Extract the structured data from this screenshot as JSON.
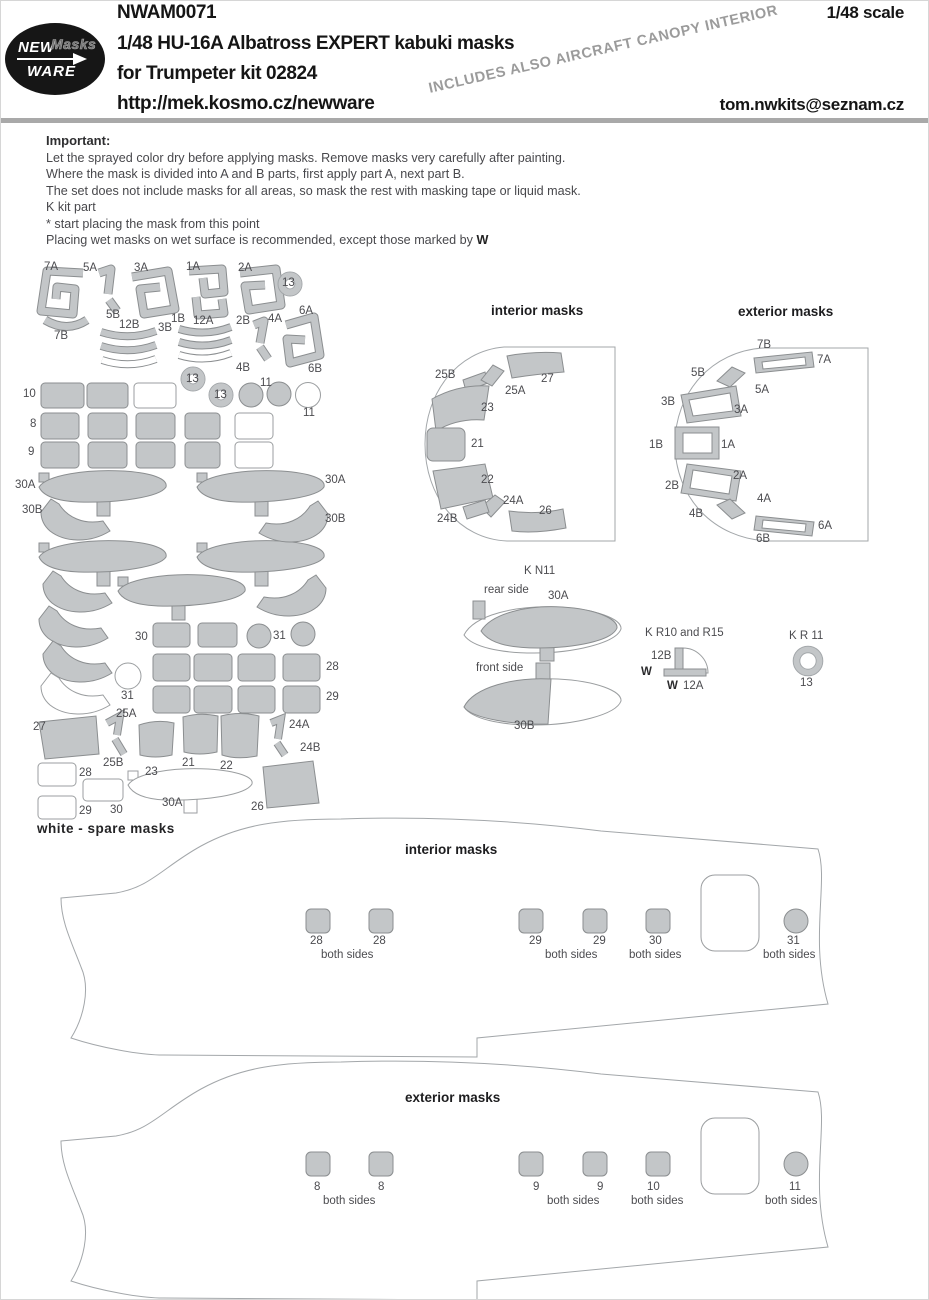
{
  "colors": {
    "mask_fill": "#c3c6c8",
    "mask_stroke": "#8b8e90",
    "outline": "#a3a7aa",
    "divider": "#a9a9a9",
    "banner_text": "#9b9b9b"
  },
  "header": {
    "logo": {
      "line1": "NEW",
      "line2": "Masks",
      "line3": "WARE"
    },
    "code": "NWAM0071",
    "title_line1": "1/48  HU-16A Albatross EXPERT kabuki masks",
    "title_line2": "for Trumpeter kit 02824",
    "url": "http://mek.kosmo.cz/newware",
    "scale": "1/48 scale",
    "banner": "INCLUDES ALSO AIRCRAFT CANOPY INTERIOR",
    "email": "tom.nwkits@seznam.cz"
  },
  "instructions": {
    "heading": "Important:",
    "lines": [
      "Let the sprayed color dry before applying masks. Remove masks very carefully after painting.",
      "Where the mask is divided into A and B parts, first apply part A, next part B.",
      "The set does not include masks for all areas, so mask the rest with masking tape or liquid mask.",
      "K  kit part",
      "*   start placing the mask from this point"
    ],
    "wet_line_prefix": "Placing wet masks on wet surface is recommended, except those marked by ",
    "wet_marker": "W"
  },
  "sheet": {
    "spare_note": "white - spare masks",
    "labels": [
      {
        "t": "7A",
        "x": 35,
        "y": 5
      },
      {
        "t": "5A",
        "x": 74,
        "y": 6
      },
      {
        "t": "3A",
        "x": 125,
        "y": 6
      },
      {
        "t": "1A",
        "x": 177,
        "y": 5
      },
      {
        "t": "2A",
        "x": 229,
        "y": 6
      },
      {
        "t": "13",
        "x": 273,
        "y": 21
      },
      {
        "t": "7B",
        "x": 45,
        "y": 74
      },
      {
        "t": "5B",
        "x": 97,
        "y": 53
      },
      {
        "t": "12B",
        "x": 110,
        "y": 63
      },
      {
        "t": "3B",
        "x": 149,
        "y": 66
      },
      {
        "t": "1B",
        "x": 162,
        "y": 57
      },
      {
        "t": "12A",
        "x": 184,
        "y": 59
      },
      {
        "t": "2B",
        "x": 227,
        "y": 59
      },
      {
        "t": "4A",
        "x": 259,
        "y": 57
      },
      {
        "t": "6A",
        "x": 290,
        "y": 49
      },
      {
        "t": "4B",
        "x": 227,
        "y": 106
      },
      {
        "t": "6B",
        "x": 299,
        "y": 107
      },
      {
        "t": "13",
        "x": 177,
        "y": 117
      },
      {
        "t": "13",
        "x": 205,
        "y": 133
      },
      {
        "t": "11",
        "x": 251,
        "y": 121
      },
      {
        "t": "11",
        "x": 294,
        "y": 151
      },
      {
        "t": "10",
        "x": 14,
        "y": 132
      },
      {
        "t": "8",
        "x": 21,
        "y": 162
      },
      {
        "t": "9",
        "x": 19,
        "y": 190
      },
      {
        "t": "30A",
        "x": 6,
        "y": 223
      },
      {
        "t": "30A",
        "x": 316,
        "y": 218
      },
      {
        "t": "30B",
        "x": 13,
        "y": 248
      },
      {
        "t": "30B",
        "x": 316,
        "y": 257
      },
      {
        "t": "30",
        "x": 126,
        "y": 375
      },
      {
        "t": "31",
        "x": 264,
        "y": 374
      },
      {
        "t": "28",
        "x": 317,
        "y": 405
      },
      {
        "t": "29",
        "x": 317,
        "y": 435
      },
      {
        "t": "31",
        "x": 112,
        "y": 434
      },
      {
        "t": "25A",
        "x": 107,
        "y": 452
      },
      {
        "t": "27",
        "x": 24,
        "y": 465
      },
      {
        "t": "25B",
        "x": 94,
        "y": 501
      },
      {
        "t": "23",
        "x": 136,
        "y": 510
      },
      {
        "t": "21",
        "x": 173,
        "y": 501
      },
      {
        "t": "22",
        "x": 211,
        "y": 504
      },
      {
        "t": "24A",
        "x": 280,
        "y": 463
      },
      {
        "t": "24B",
        "x": 291,
        "y": 486
      },
      {
        "t": "28",
        "x": 70,
        "y": 511
      },
      {
        "t": "30",
        "x": 101,
        "y": 548
      },
      {
        "t": "29",
        "x": 70,
        "y": 549
      },
      {
        "t": "30A",
        "x": 153,
        "y": 541
      },
      {
        "t": "26",
        "x": 242,
        "y": 545
      }
    ]
  },
  "interior_diagram": {
    "title": "interior masks",
    "labels": [
      {
        "t": "25B",
        "x": 16,
        "y": 68
      },
      {
        "t": "25A",
        "x": 86,
        "y": 84
      },
      {
        "t": "27",
        "x": 122,
        "y": 72
      },
      {
        "t": "23",
        "x": 62,
        "y": 101
      },
      {
        "t": "21",
        "x": 52,
        "y": 137
      },
      {
        "t": "22",
        "x": 62,
        "y": 173
      },
      {
        "t": "24A",
        "x": 84,
        "y": 194
      },
      {
        "t": "24B",
        "x": 18,
        "y": 212
      },
      {
        "t": "26",
        "x": 120,
        "y": 204
      }
    ]
  },
  "exterior_diagram": {
    "title": "exterior masks",
    "labels": [
      {
        "t": "7B",
        "x": 108,
        "y": 38
      },
      {
        "t": "7A",
        "x": 168,
        "y": 53
      },
      {
        "t": "5B",
        "x": 42,
        "y": 66
      },
      {
        "t": "5A",
        "x": 106,
        "y": 83
      },
      {
        "t": "3B",
        "x": 12,
        "y": 95
      },
      {
        "t": "3A",
        "x": 85,
        "y": 103
      },
      {
        "t": "1B",
        "x": 0,
        "y": 138
      },
      {
        "t": "1A",
        "x": 72,
        "y": 138
      },
      {
        "t": "2B",
        "x": 16,
        "y": 179
      },
      {
        "t": "2A",
        "x": 84,
        "y": 169
      },
      {
        "t": "4B",
        "x": 40,
        "y": 207
      },
      {
        "t": "4A",
        "x": 108,
        "y": 192
      },
      {
        "t": "6B",
        "x": 107,
        "y": 232
      },
      {
        "t": "6A",
        "x": 169,
        "y": 219
      }
    ]
  },
  "kn11": {
    "labels": [
      {
        "t": "K N11",
        "x": 68,
        "y": 6
      },
      {
        "t": "rear side",
        "x": 28,
        "y": 25
      },
      {
        "t": "30A",
        "x": 92,
        "y": 31
      },
      {
        "t": "front side",
        "x": 20,
        "y": 103
      },
      {
        "t": "30B",
        "x": 58,
        "y": 161
      }
    ]
  },
  "kr10": {
    "labels": [
      {
        "t": "K R10 and R15",
        "x": 6,
        "y": 4
      },
      {
        "t": "12B",
        "x": 12,
        "y": 27
      },
      {
        "t": "W",
        "x": 2,
        "y": 43,
        "b": 1
      },
      {
        "t": "W",
        "x": 28,
        "y": 57,
        "b": 1
      },
      {
        "t": "12A",
        "x": 44,
        "y": 57
      }
    ]
  },
  "kr11": {
    "labels": [
      {
        "t": "K R 11",
        "x": 6,
        "y": 7
      },
      {
        "t": "13",
        "x": 17,
        "y": 54
      }
    ]
  },
  "fuselage_interior": {
    "title": "interior masks",
    "labels": [
      {
        "t": "28",
        "x": 309,
        "y": 934
      },
      {
        "t": "28",
        "x": 372,
        "y": 934
      },
      {
        "t": "both sides",
        "x": 320,
        "y": 948
      },
      {
        "t": "29",
        "x": 528,
        "y": 934
      },
      {
        "t": "29",
        "x": 592,
        "y": 934
      },
      {
        "t": "both sides",
        "x": 544,
        "y": 948
      },
      {
        "t": "30",
        "x": 648,
        "y": 934
      },
      {
        "t": "both sides",
        "x": 628,
        "y": 948
      },
      {
        "t": "31",
        "x": 786,
        "y": 934
      },
      {
        "t": "both sides",
        "x": 762,
        "y": 948
      }
    ]
  },
  "fuselage_exterior": {
    "title": "exterior masks",
    "labels": [
      {
        "t": "8",
        "x": 313,
        "y": 1180
      },
      {
        "t": "8",
        "x": 377,
        "y": 1180
      },
      {
        "t": "both sides",
        "x": 322,
        "y": 1194
      },
      {
        "t": "9",
        "x": 532,
        "y": 1180
      },
      {
        "t": "9",
        "x": 596,
        "y": 1180
      },
      {
        "t": "both sides",
        "x": 546,
        "y": 1194
      },
      {
        "t": "10",
        "x": 646,
        "y": 1180
      },
      {
        "t": "both sides",
        "x": 630,
        "y": 1194
      },
      {
        "t": "11",
        "x": 788,
        "y": 1180
      },
      {
        "t": "both sides",
        "x": 764,
        "y": 1194
      }
    ]
  }
}
